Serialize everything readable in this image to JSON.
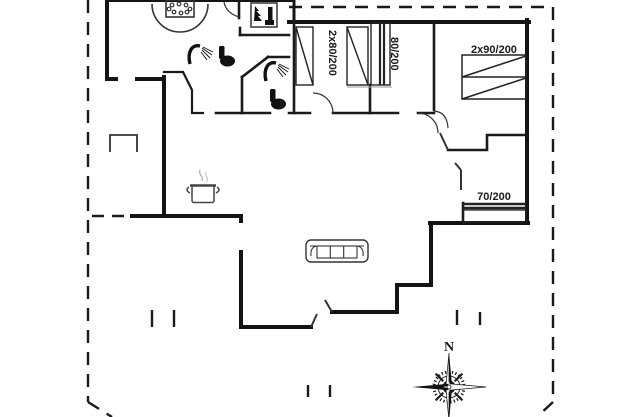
{
  "floorplan": {
    "background": "#ffffff",
    "line_color": "#1a1a1a",
    "muted_line_color": "#555555",
    "bed_labels": {
      "twin_80": "2x80/200",
      "single_80": "80/200",
      "double_90": "2x90/200",
      "single_70": "70/200"
    },
    "compass": {
      "north": "N"
    },
    "icons": [
      {
        "name": "whirlpool-icon"
      },
      {
        "name": "fireplace-stove-icon"
      },
      {
        "name": "shower-icon"
      },
      {
        "name": "shower-icon"
      },
      {
        "name": "toilet-icon"
      },
      {
        "name": "toilet-icon"
      },
      {
        "name": "cooking-pot-icon"
      },
      {
        "name": "sofa-icon"
      },
      {
        "name": "compass-rose-icon"
      }
    ]
  }
}
